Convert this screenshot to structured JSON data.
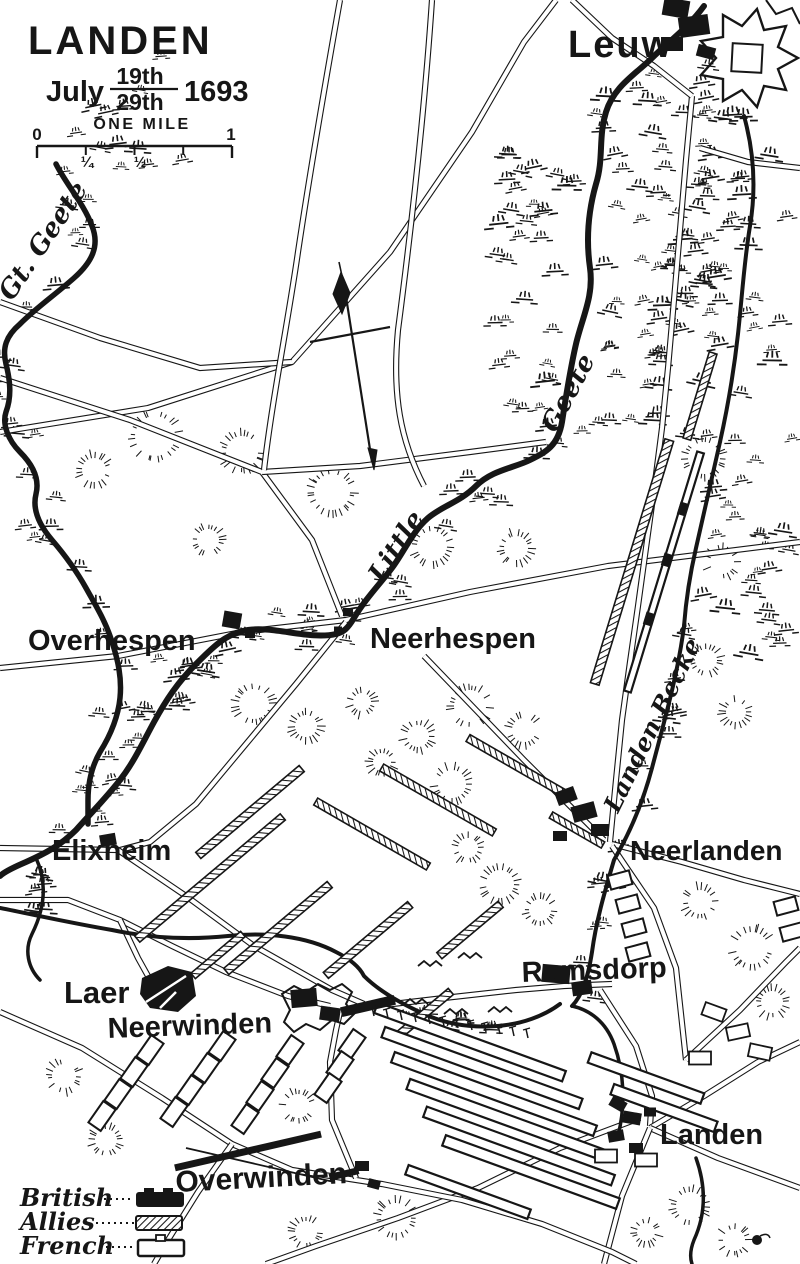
{
  "map": {
    "title": "LANDEN",
    "date": {
      "month": "July",
      "numerator": "19th",
      "denominator": "29th",
      "year": "1693"
    },
    "scale": {
      "label": "ONE MILE",
      "tick_zero": "0",
      "tick_quarter": "¼",
      "tick_half": "½",
      "tick_one": "1"
    },
    "places": {
      "leuw": "Leuw",
      "overhespen": "Overhespen",
      "neerhespen": "Neerhespen",
      "elixheim": "Elixheim",
      "neerlanden": "Neerlanden",
      "laer": "Laer",
      "neerwinden": "Neerwinden",
      "rumsdorp": "Rumsdorp",
      "landen": "Landen",
      "overwinden": "Overwinden"
    },
    "rivers": {
      "great_geete": "Gt. Geete",
      "little": "Little",
      "geete": "Geete",
      "landen_becke": "Landen Becke"
    },
    "legend": {
      "entries": [
        {
          "label": "British",
          "symbol": "solid-black-bar"
        },
        {
          "label": "Allies",
          "symbol": "hatched-bar"
        },
        {
          "label": "French",
          "symbol": "hollow-bar"
        }
      ]
    },
    "colors": {
      "ink": "#161616",
      "paper": "#ffffff"
    }
  }
}
